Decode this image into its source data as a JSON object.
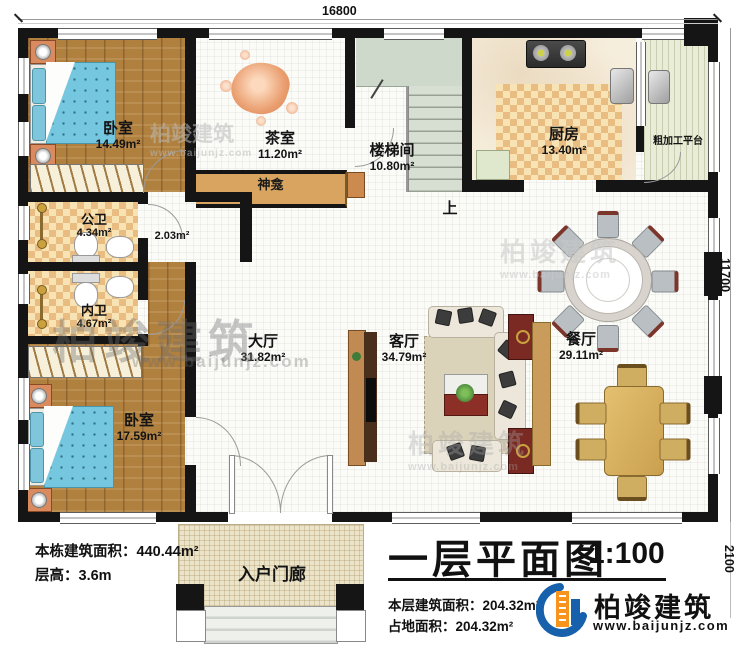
{
  "plan": {
    "dim_top": "16800",
    "dim_right": "11700",
    "dim_porch": "2100",
    "stairs_up": "上"
  },
  "rooms": {
    "bedroom1": {
      "label": "卧室",
      "area": "14.49m²"
    },
    "tea_room": {
      "label": "茶室",
      "area": "11.20m²"
    },
    "shrine": {
      "label": "神龛"
    },
    "stairwell": {
      "label": "楼梯间",
      "area": "10.80m²"
    },
    "kitchen": {
      "label": "厨房",
      "area": "13.40m²"
    },
    "prep_platform": {
      "label": "粗加工平台"
    },
    "public_bath": {
      "label": "公卫",
      "area": "4.34m²"
    },
    "inner_bath": {
      "label": "内卫",
      "area": "4.67m²"
    },
    "corridor": {
      "area": "2.03m²"
    },
    "main_hall": {
      "label": "大厅",
      "area": "31.82m²"
    },
    "living_room": {
      "label": "客厅",
      "area": "34.79m²"
    },
    "dining_room": {
      "label": "餐厅",
      "area": "29.11m²"
    },
    "bedroom2": {
      "label": "卧室",
      "area": "17.59m²"
    },
    "porch": {
      "label": "入户门廊"
    }
  },
  "info": {
    "total_area": "本栋建筑面积：440.44m²",
    "floor_height": "层高：3.6m"
  },
  "title_block": {
    "title": "一层平面图",
    "scale": "1:100",
    "floor_area": "本层建筑面积：204.32m²",
    "footprint_area": "占地面积：204.32m²"
  },
  "brand": {
    "name": "柏竣建筑",
    "website": "www.baijunjz.com"
  },
  "watermark": {
    "name": "柏竣建筑",
    "website": "www.baijunjz.com"
  },
  "colors": {
    "brand_blue": "#1761ac",
    "brand_orange": "#f7941d"
  }
}
